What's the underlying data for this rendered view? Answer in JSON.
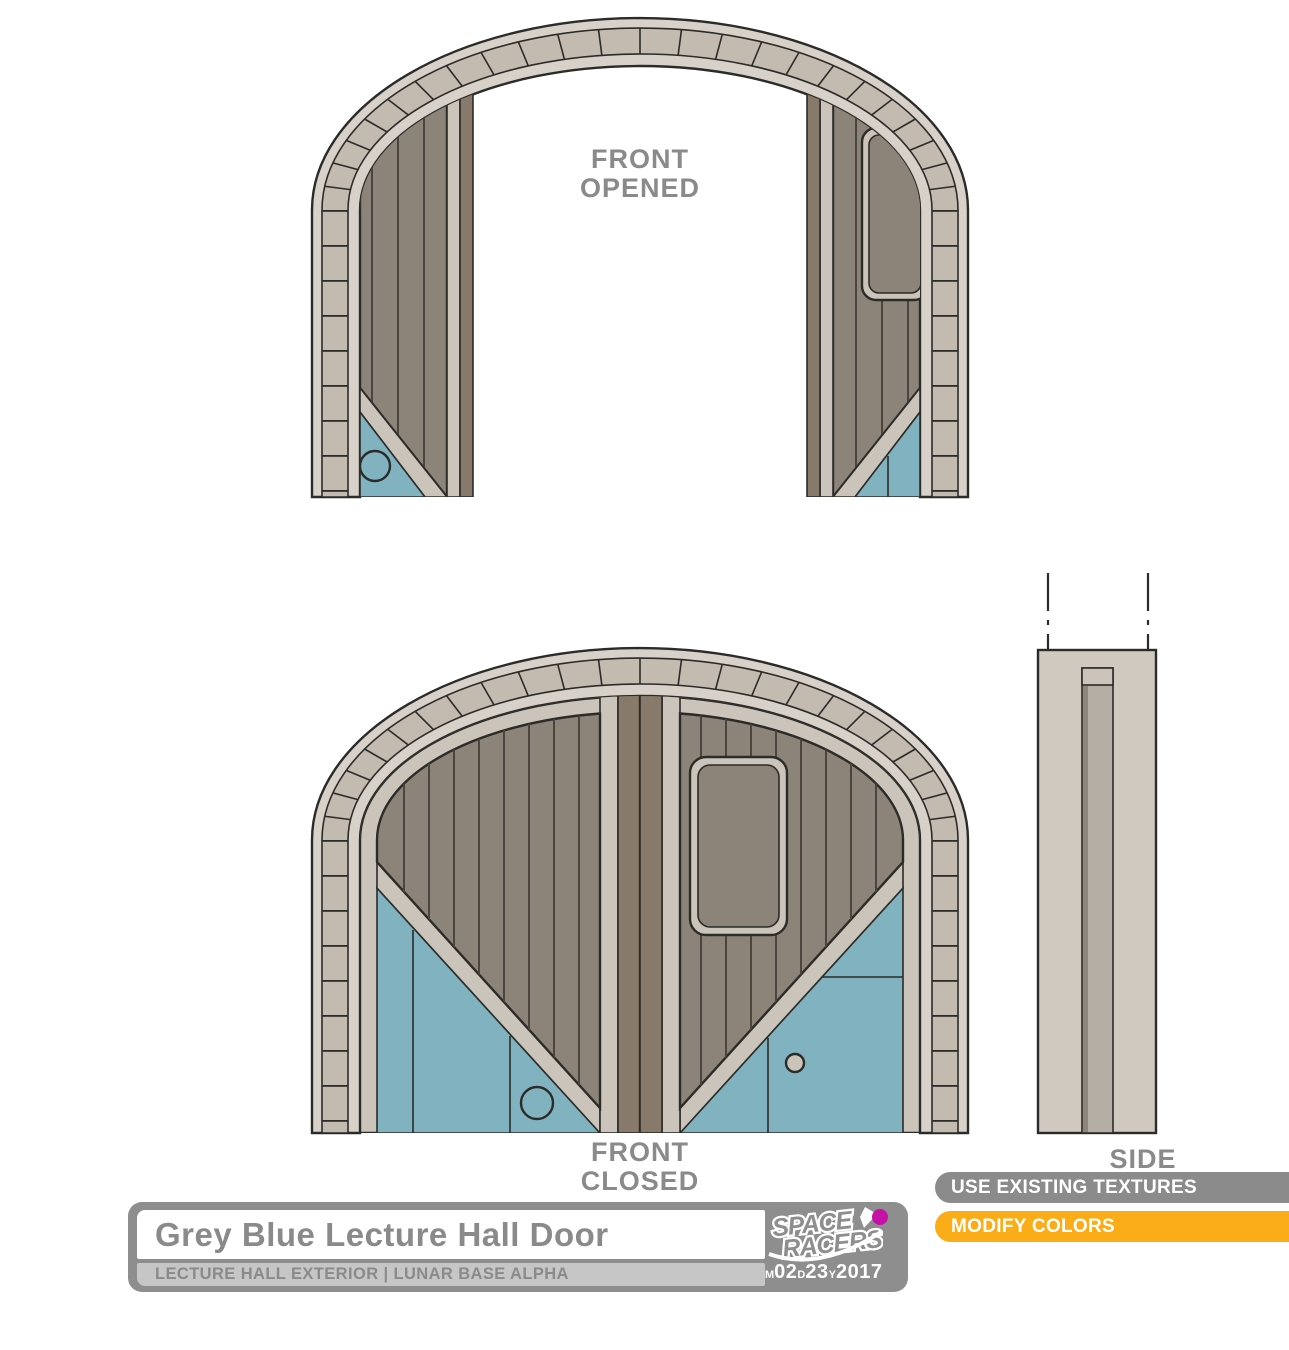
{
  "views": {
    "front_opened": {
      "label_line1": "FRONT",
      "label_line2": "OPENED"
    },
    "front_closed": {
      "label_line1": "FRONT",
      "label_line2": "CLOSED"
    },
    "side": {
      "label": "SIDE"
    }
  },
  "title_block": {
    "title": "Grey Blue Lecture Hall Door",
    "subtitle": "LECTURE HALL EXTERIOR | LUNAR BASE ALPHA",
    "logo_line1": "SPACE",
    "logo_line2": "RACERS",
    "date": {
      "m_label": "M",
      "month": "02",
      "d_label": "D",
      "day": "23",
      "y_label": "Y",
      "year": "2017"
    }
  },
  "annotations": {
    "banner1": "USE EXISTING TEXTURES",
    "banner2": "MODIFY COLORS"
  },
  "colors": {
    "arch_ring": "#D7D1C9",
    "arch_voussoir": "#C3BAB0",
    "frame": "#CBC4BA",
    "wood": "#8C8479",
    "wood_line": "#4A453F",
    "dark_edge": "#877A6A",
    "door_blue": "#80B2C0",
    "outline": "#2B2B28",
    "label_grey": "#8A8A8A",
    "block_grey": "#8E8E8E",
    "block_light": "#C6C6C6",
    "banner_grey": "#8B8B8B",
    "banner_orange": "#FBAD18",
    "magenta": "#C511A5",
    "side_body": "#CFC9C0",
    "side_slot": "#B5AEA4",
    "side_slot_shadow": "#8E867B"
  }
}
